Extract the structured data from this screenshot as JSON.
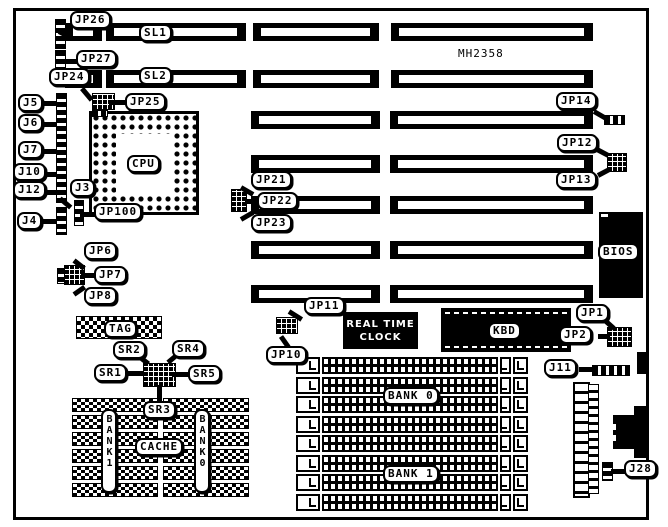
{
  "diagram": {
    "model": "MH2358",
    "cpu_label": "CPU",
    "bios_label": "BIOS",
    "kbd_label": "KBD",
    "tag_label": "TAG",
    "cache_label": "CACHE",
    "cache_bank_1_label": "BANK1",
    "cache_bank_0_label": "BANK0",
    "rtc_line1": "REAL TIME",
    "rtc_line2": "CLOCK",
    "slot_labels": {
      "sl1": "SL1",
      "sl2": "SL2"
    },
    "simm_bank_labels": {
      "bank0": "BANK 0",
      "bank1": "BANK 1"
    },
    "simm_socket_count": 8,
    "jumper_labels": {
      "jp1": "JP1",
      "jp2": "JP2",
      "jp6": "JP6",
      "jp7": "JP7",
      "jp8": "JP8",
      "jp10": "JP10",
      "jp11": "JP11",
      "jp12": "JP12",
      "jp13": "JP13",
      "jp14": "JP14",
      "jp21": "JP21",
      "jp22": "JP22",
      "jp23": "JP23",
      "jp24": "JP24",
      "jp25": "JP25",
      "jp26": "JP26",
      "jp27": "JP27",
      "jp100": "JP100"
    },
    "connector_labels": {
      "j3": "J3",
      "j4": "J4",
      "j5": "J5",
      "j6": "J6",
      "j7": "J7",
      "j10": "J10",
      "j11": "J11",
      "j12": "J12",
      "j28": "J28"
    },
    "sram_labels": {
      "sr1": "SR1",
      "sr2": "SR2",
      "sr3": "SR3",
      "sr4": "SR4",
      "sr5": "SR5"
    }
  }
}
